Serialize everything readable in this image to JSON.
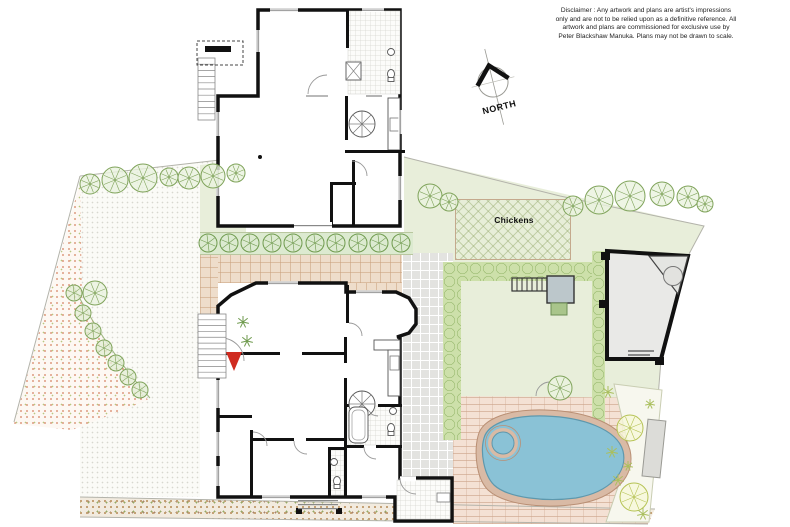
{
  "disclaimer": {
    "lines": [
      "Disclaimer : Any artwork and plans are artist's impressions",
      "only and are not to be relied upon as a definitive reference. All",
      "artwork and plans are commissioned for exclusive use by",
      "Peter Blackshaw Manuka. Plans may not be drawn to scale."
    ]
  },
  "compass": {
    "label": "NORTH"
  },
  "colors": {
    "wall": "#111111",
    "lawn": "#e8eeda",
    "hedge": "#cde0aa",
    "hedge_scallop": "#84aa58",
    "courtyard_brick": "#eeddcb",
    "pool_paving": "#f4e1d4",
    "path_gray": "#e3e3e0",
    "pool_water": "#8ac2d6",
    "pool_coping": "#d9baa5",
    "entry_arrow": "#cf2b20",
    "tree_stroke": "#7fa35a",
    "boundary": "#b3b3aa"
  },
  "plan": {
    "areas": [
      {
        "name": "lawn-left",
        "cls": "lawn-dots",
        "clip": "polygon(80px 176px, 246px 157px, 246px 160px, 200px 165px, 200px 497px, 80px 497px)"
      },
      {
        "name": "lawn-strip-garage",
        "cls": "lawn",
        "clip": "polygon(200px 165px, 246px 160px, 246px 232px, 200px 232px)"
      },
      {
        "name": "lawn-right",
        "cls": "lawn",
        "clip": "polygon(404px 157px, 704px 226px, 689px 254px, 661px 360px, 657px 402px, 404px 402px)"
      },
      {
        "name": "garden-bed-red-stipple",
        "cls": "stipple-red",
        "clip": "polygon(80px 182px, 14px 424px, 72px 430px, 148px 400px, 108px 348px, 82px 300px)"
      },
      {
        "name": "street-verge",
        "cls": "verge",
        "clip": "polygon(80px 497px, 655px 509px, 648px 524px, 80px 517px)"
      },
      {
        "name": "courtyard-top",
        "cls": "bricks-tan",
        "x": 200,
        "y": 253,
        "w": 213,
        "h": 30
      },
      {
        "name": "courtyard-dining-strip",
        "cls": "bricks-tan",
        "x": 346,
        "y": 283,
        "w": 58,
        "h": 10
      },
      {
        "name": "courtyard-entry",
        "cls": "bricks-tan",
        "x": 200,
        "y": 253,
        "w": 18,
        "h": 125
      },
      {
        "name": "side-path",
        "cls": "tiles-gray",
        "x": 402,
        "y": 253,
        "w": 51,
        "h": 225
      },
      {
        "name": "pool-paving",
        "cls": "bricks-pink",
        "x": 453,
        "y": 396,
        "w": 208,
        "h": 128,
        "clip": "polygon(0px 0px, 206px 2px, 195px 128px, 0px 128px)"
      },
      {
        "name": "shrub-strip",
        "cls": "shrubrow",
        "x": 200,
        "y": 232,
        "w": 213,
        "h": 21
      },
      {
        "name": "chickens-pen",
        "cls": "crosshatch",
        "x": 455,
        "y": 199,
        "w": 114,
        "h": 59,
        "border": "1px solid #c4a98d"
      },
      {
        "name": "hedge-top",
        "cls": "hedge",
        "x": 443,
        "y": 262,
        "w": 170,
        "h": 19
      },
      {
        "name": "hedge-left",
        "cls": "hedge",
        "x": 443,
        "y": 262,
        "w": 18,
        "h": 178
      },
      {
        "name": "hedge-cabana",
        "cls": "hedge",
        "x": 592,
        "y": 251,
        "w": 13,
        "h": 175
      }
    ],
    "boundaries": [
      "M80,176 L246,157",
      "M404,157 L560,196 L704,226 L689,254",
      "M661,360 L648,522",
      "M80,176 L14,422",
      "M80,497 L655,509",
      "M80,517 L648,524"
    ],
    "curve": "M72,284 Q104,346 150,398",
    "buildings": [
      {
        "name": "garage-building",
        "d": "M258,10 L400,10 L400,226 L218,226 L218,96 L258,96 Z",
        "fill": "#ffffff",
        "stroke": "#111",
        "sw": 3.5
      },
      {
        "name": "main-house",
        "d": "M256,283 L346,283 L346,292 L396,292 L409,298 L416,309 L416,324 L409,333 L397,337 L400,337 L400,478 L452,478 L452,521 L395,521 L395,497 L218,497 L218,306 L231,295 Z",
        "fill": "#ffffff",
        "stroke": "#111",
        "sw": 3.5
      },
      {
        "name": "cabana",
        "d": "M607,251 L688,256 L661,359 L607,359 Z",
        "fill": "#e9e9e7",
        "stroke": "#111",
        "sw": 4
      }
    ],
    "tiled": [
      [
        348,
        11,
        52,
        83
      ],
      [
        348,
        406,
        52,
        39
      ],
      [
        330,
        449,
        14,
        46
      ],
      [
        397,
        480,
        53,
        39
      ]
    ],
    "walls": [
      [
        346,
        10,
        3,
        38
      ],
      [
        345,
        96,
        3,
        44
      ],
      [
        345,
        150,
        60,
        3
      ],
      [
        352,
        160,
        3,
        66
      ],
      [
        330,
        182,
        3,
        44
      ],
      [
        330,
        182,
        26,
        3
      ],
      [
        205,
        46,
        26,
        6
      ],
      [
        346,
        285,
        3,
        38
      ],
      [
        218,
        352,
        62,
        3
      ],
      [
        302,
        352,
        44,
        3
      ],
      [
        344,
        337,
        3,
        26
      ],
      [
        344,
        378,
        3,
        28
      ],
      [
        344,
        406,
        3,
        41
      ],
      [
        346,
        404,
        20,
        3
      ],
      [
        378,
        404,
        24,
        3
      ],
      [
        346,
        445,
        18,
        3
      ],
      [
        376,
        445,
        26,
        3
      ],
      [
        328,
        447,
        3,
        50
      ],
      [
        344,
        447,
        3,
        50
      ],
      [
        328,
        447,
        16,
        3
      ],
      [
        250,
        430,
        3,
        67
      ],
      [
        218,
        415,
        34,
        3
      ],
      [
        252,
        438,
        42,
        3
      ],
      [
        306,
        438,
        38,
        3
      ],
      [
        296,
        508,
        6,
        6
      ],
      [
        336,
        508,
        6,
        6
      ]
    ],
    "openings": [
      [
        270,
        8.3,
        28,
        3.6,
        "h"
      ],
      [
        362,
        8.3,
        22,
        3.6,
        "h"
      ],
      [
        256.3,
        30,
        3.6,
        22,
        "v"
      ],
      [
        398.3,
        110,
        3.6,
        24,
        "v"
      ],
      [
        398.3,
        176,
        3.6,
        24,
        "v"
      ],
      [
        216.3,
        112,
        3.6,
        24,
        "v"
      ],
      [
        216.3,
        170,
        3.6,
        26,
        "v"
      ],
      [
        306,
        94.3,
        22,
        3.4,
        "h"
      ],
      [
        366,
        94.3,
        16,
        3.4,
        "h"
      ],
      [
        268,
        281.3,
        30,
        3.6,
        "h"
      ],
      [
        356,
        290.3,
        26,
        3.6,
        "h"
      ],
      [
        216.3,
        380,
        3.6,
        28,
        "v"
      ],
      [
        216.3,
        432,
        3.6,
        24,
        "v"
      ],
      [
        216.3,
        466,
        3.6,
        20,
        "v"
      ],
      [
        262,
        495.3,
        28,
        3.6,
        "h"
      ],
      [
        362,
        495.3,
        24,
        3.6,
        "h"
      ],
      [
        215.5,
        336,
        6,
        26,
        "door"
      ],
      [
        400,
        476.3,
        16,
        5,
        "door"
      ],
      [
        294,
        222,
        38,
        6,
        "door"
      ]
    ],
    "counters": [
      [
        388,
        98,
        12,
        52
      ],
      [
        374,
        340,
        26,
        10
      ],
      [
        388,
        350,
        12,
        46
      ]
    ],
    "sinks": [
      [
        390,
        118,
        9,
        13
      ],
      [
        390,
        356,
        9,
        14
      ],
      [
        437,
        493,
        13,
        9
      ]
    ],
    "spirals": [
      [
        362,
        124,
        13
      ],
      [
        362,
        404,
        13
      ]
    ],
    "toilets": [
      [
        391,
        74
      ],
      [
        391,
        428
      ],
      [
        337,
        481
      ]
    ],
    "basins": [
      [
        391,
        52
      ],
      [
        393,
        411
      ],
      [
        334,
        462
      ]
    ],
    "arcs": [
      "M221,338 A23,23 0 0 1 244,361",
      "M308,94 A19,19 0 0 1 327,75",
      "M352,161 A15,15 0 0 1 367,176",
      "M349,323 A13,13 0 0 1 362,336",
      "M253,432 A14,14 0 0 1 267,446",
      "M294,441 A13,13 0 0 0 307,454",
      "M364,447 A12,12 0 0 0 376,459",
      "M366,404 A12,12 0 0 0 378,416",
      "M400,478 A16,16 0 0 0 416,494",
      "M536,396 A14,14 0 0 1 550,382"
    ],
    "steps": [
      {
        "name": "entry-steps",
        "x": 198,
        "y": 314,
        "w": 28,
        "h": 64,
        "n": 11
      },
      {
        "name": "deck-stairs",
        "x": 198,
        "y": 58,
        "w": 17,
        "h": 62,
        "n": 10
      }
    ],
    "step_lines": [
      [
        298,
        500,
        40,
        1.2
      ],
      [
        298,
        504,
        40,
        1.2
      ],
      [
        298,
        508,
        40,
        1.2
      ],
      [
        628,
        350,
        26,
        2
      ],
      [
        628,
        354,
        22,
        2
      ],
      [
        294,
        225,
        38,
        1.2
      ]
    ],
    "posts": [
      [
        601,
        252,
        9,
        8
      ],
      [
        599,
        300,
        9,
        8
      ],
      [
        655,
        357,
        9,
        8
      ]
    ],
    "pool": {
      "coping_d": "M478,436 C482,418 510,409 545,410 C586,411 623,424 630,450 C636,476 615,498 578,504 C544,509 504,505 488,490 C476,478 474,452 478,436 Z",
      "water_d": "M484,438 C488,423 513,415 545,416 C582,417 617,429 623,451 C628,472 610,492 576,498 C545,502 508,498 494,485 C484,475 480,452 484,438 Z",
      "spa": {
        "cx": 503,
        "cy": 443,
        "r": 15
      }
    },
    "pool_bed": {
      "d": "M614,384 L662,390 L649,522 L606,522 L630,452 Z"
    },
    "bench": {
      "x": 645,
      "y": 420,
      "w": 18,
      "h": 57,
      "rot": "rotate(6 654 448)"
    },
    "pergola": {
      "x": 512,
      "y": 278,
      "w": 35,
      "h": 13,
      "n": 6
    },
    "shed": {
      "x": 547,
      "y": 276,
      "w": 27,
      "h": 27
    },
    "greenbox": {
      "x": 551,
      "y": 303,
      "w": 16,
      "h": 12
    },
    "pizza_corner": {
      "tri": "M649,256 L688,256 L678,294 Z",
      "cx": 673,
      "cy": 276,
      "r": 9.5
    },
    "entry_triangle": "226,352 242,352 234,371",
    "deck_dashed": {
      "x": 197,
      "y": 41,
      "w": 46,
      "h": 24
    },
    "tub": {
      "x": 349,
      "y": 407,
      "w": 19,
      "h": 36
    },
    "xbox": {
      "x": 346,
      "y": 62,
      "w": 15,
      "h": 18
    },
    "garage_dot": {
      "cx": 260,
      "cy": 157,
      "r": 2
    },
    "trees_green": [
      [
        90,
        184,
        10
      ],
      [
        115,
        180,
        13
      ],
      [
        143,
        178,
        14
      ],
      [
        169,
        177,
        9
      ],
      [
        189,
        178,
        11
      ],
      [
        213,
        176,
        12
      ],
      [
        236,
        173,
        9
      ],
      [
        430,
        196,
        12
      ],
      [
        449,
        202,
        9
      ],
      [
        573,
        206,
        10
      ],
      [
        599,
        200,
        14
      ],
      [
        630,
        196,
        15
      ],
      [
        662,
        194,
        12
      ],
      [
        688,
        197,
        11
      ],
      [
        705,
        204,
        8
      ],
      [
        95,
        293,
        12
      ],
      [
        560,
        388,
        12
      ]
    ],
    "trees_yellow": [
      [
        630,
        428,
        13
      ],
      [
        634,
        497,
        14
      ]
    ],
    "shrub_row_y": 243,
    "shrub_row_x": [
      208,
      229,
      250,
      272,
      293,
      315,
      336,
      358,
      379,
      401
    ],
    "shrub_row_r": 9,
    "curve_shrubs": [
      [
        74,
        293,
        8
      ],
      [
        83,
        313,
        8
      ],
      [
        93,
        331,
        8
      ],
      [
        104,
        348,
        8
      ],
      [
        116,
        363,
        8
      ],
      [
        128,
        377,
        8
      ],
      [
        140,
        390,
        8
      ]
    ],
    "tufts_green": [
      [
        243,
        322,
        6
      ],
      [
        247,
        341,
        6
      ]
    ],
    "tufts_yellow": [
      [
        608,
        392,
        6
      ],
      [
        612,
        452,
        6
      ],
      [
        618,
        480,
        6
      ],
      [
        650,
        404,
        5
      ],
      [
        628,
        466,
        5
      ],
      [
        643,
        514,
        6
      ]
    ],
    "labels": [
      {
        "name": "room-label-rumpus-bed5",
        "text": "Rumpus\n/Bed 5",
        "x": 306,
        "y": 44,
        "fs": 8.5
      },
      {
        "name": "room-label-kitchenette",
        "text": "Kitchenette",
        "x": 377,
        "y": 114,
        "fs": 6
      },
      {
        "name": "room-label-garage",
        "text": "Garage",
        "x": 292,
        "y": 153,
        "fs": 9
      },
      {
        "name": "room-label-bed4",
        "text": "Bed 4",
        "x": 376,
        "y": 181,
        "fs": 8
      },
      {
        "name": "room-label-store",
        "text": "Store",
        "x": 342,
        "y": 205,
        "fs": 5
      },
      {
        "name": "site-label-chickens",
        "text": "Chickens",
        "x": 514,
        "y": 221,
        "fs": 8.5
      },
      {
        "name": "site-label-cabana",
        "text": "Cabana",
        "x": 641,
        "y": 307,
        "fs": 8.5
      },
      {
        "name": "site-label-pizza",
        "text": "Pizza",
        "x": 673,
        "y": 276,
        "fs": 4.5
      },
      {
        "name": "room-label-lounge",
        "text": "Lounge",
        "x": 296,
        "y": 318,
        "fs": 8.5
      },
      {
        "name": "room-label-dining",
        "text": "Dining",
        "x": 378,
        "y": 313,
        "fs": 8.5
      },
      {
        "name": "room-label-kitchen",
        "text": "Kitchen",
        "x": 374,
        "y": 367,
        "fs": 6.5
      },
      {
        "name": "room-label-living",
        "text": "Living",
        "x": 298,
        "y": 388,
        "fs": 8.5
      },
      {
        "name": "room-label-bed3",
        "text": "Bed 3",
        "x": 240,
        "y": 448,
        "fs": 8
      },
      {
        "name": "room-label-bed1",
        "text": "Bed 1",
        "x": 298,
        "y": 459,
        "fs": 8
      },
      {
        "name": "room-label-bed2",
        "text": "Bed 2",
        "x": 375,
        "y": 467,
        "fs": 8
      },
      {
        "name": "entry-label",
        "text": "ENTRY",
        "x": 230,
        "y": 343,
        "fs": 6,
        "bg": "#ffffff"
      }
    ],
    "appliance_boxes": [
      {
        "name": "washer-box-upper",
        "text": "W",
        "x": 377,
        "y": 12,
        "w": 12,
        "h": 10,
        "solid": false
      },
      {
        "name": "unit-box-upper",
        "text": "",
        "x": 391,
        "y": 12,
        "w": 7,
        "h": 10,
        "solid": false
      },
      {
        "name": "fridge-box-kitchenette",
        "text": "F",
        "x": 386,
        "y": 132,
        "w": 11,
        "h": 10,
        "solid": false
      },
      {
        "name": "fridge-box-kitchen",
        "text": "F",
        "x": 347,
        "y": 343,
        "w": 12,
        "h": 11,
        "solid": true
      },
      {
        "name": "pantry-box-kitchen",
        "text": "P",
        "x": 346,
        "y": 382,
        "w": 12,
        "h": 11,
        "solid": true
      },
      {
        "name": "washer-box-laundry",
        "text": "W",
        "x": 406,
        "y": 502,
        "w": 13,
        "h": 11,
        "solid": false
      }
    ]
  }
}
